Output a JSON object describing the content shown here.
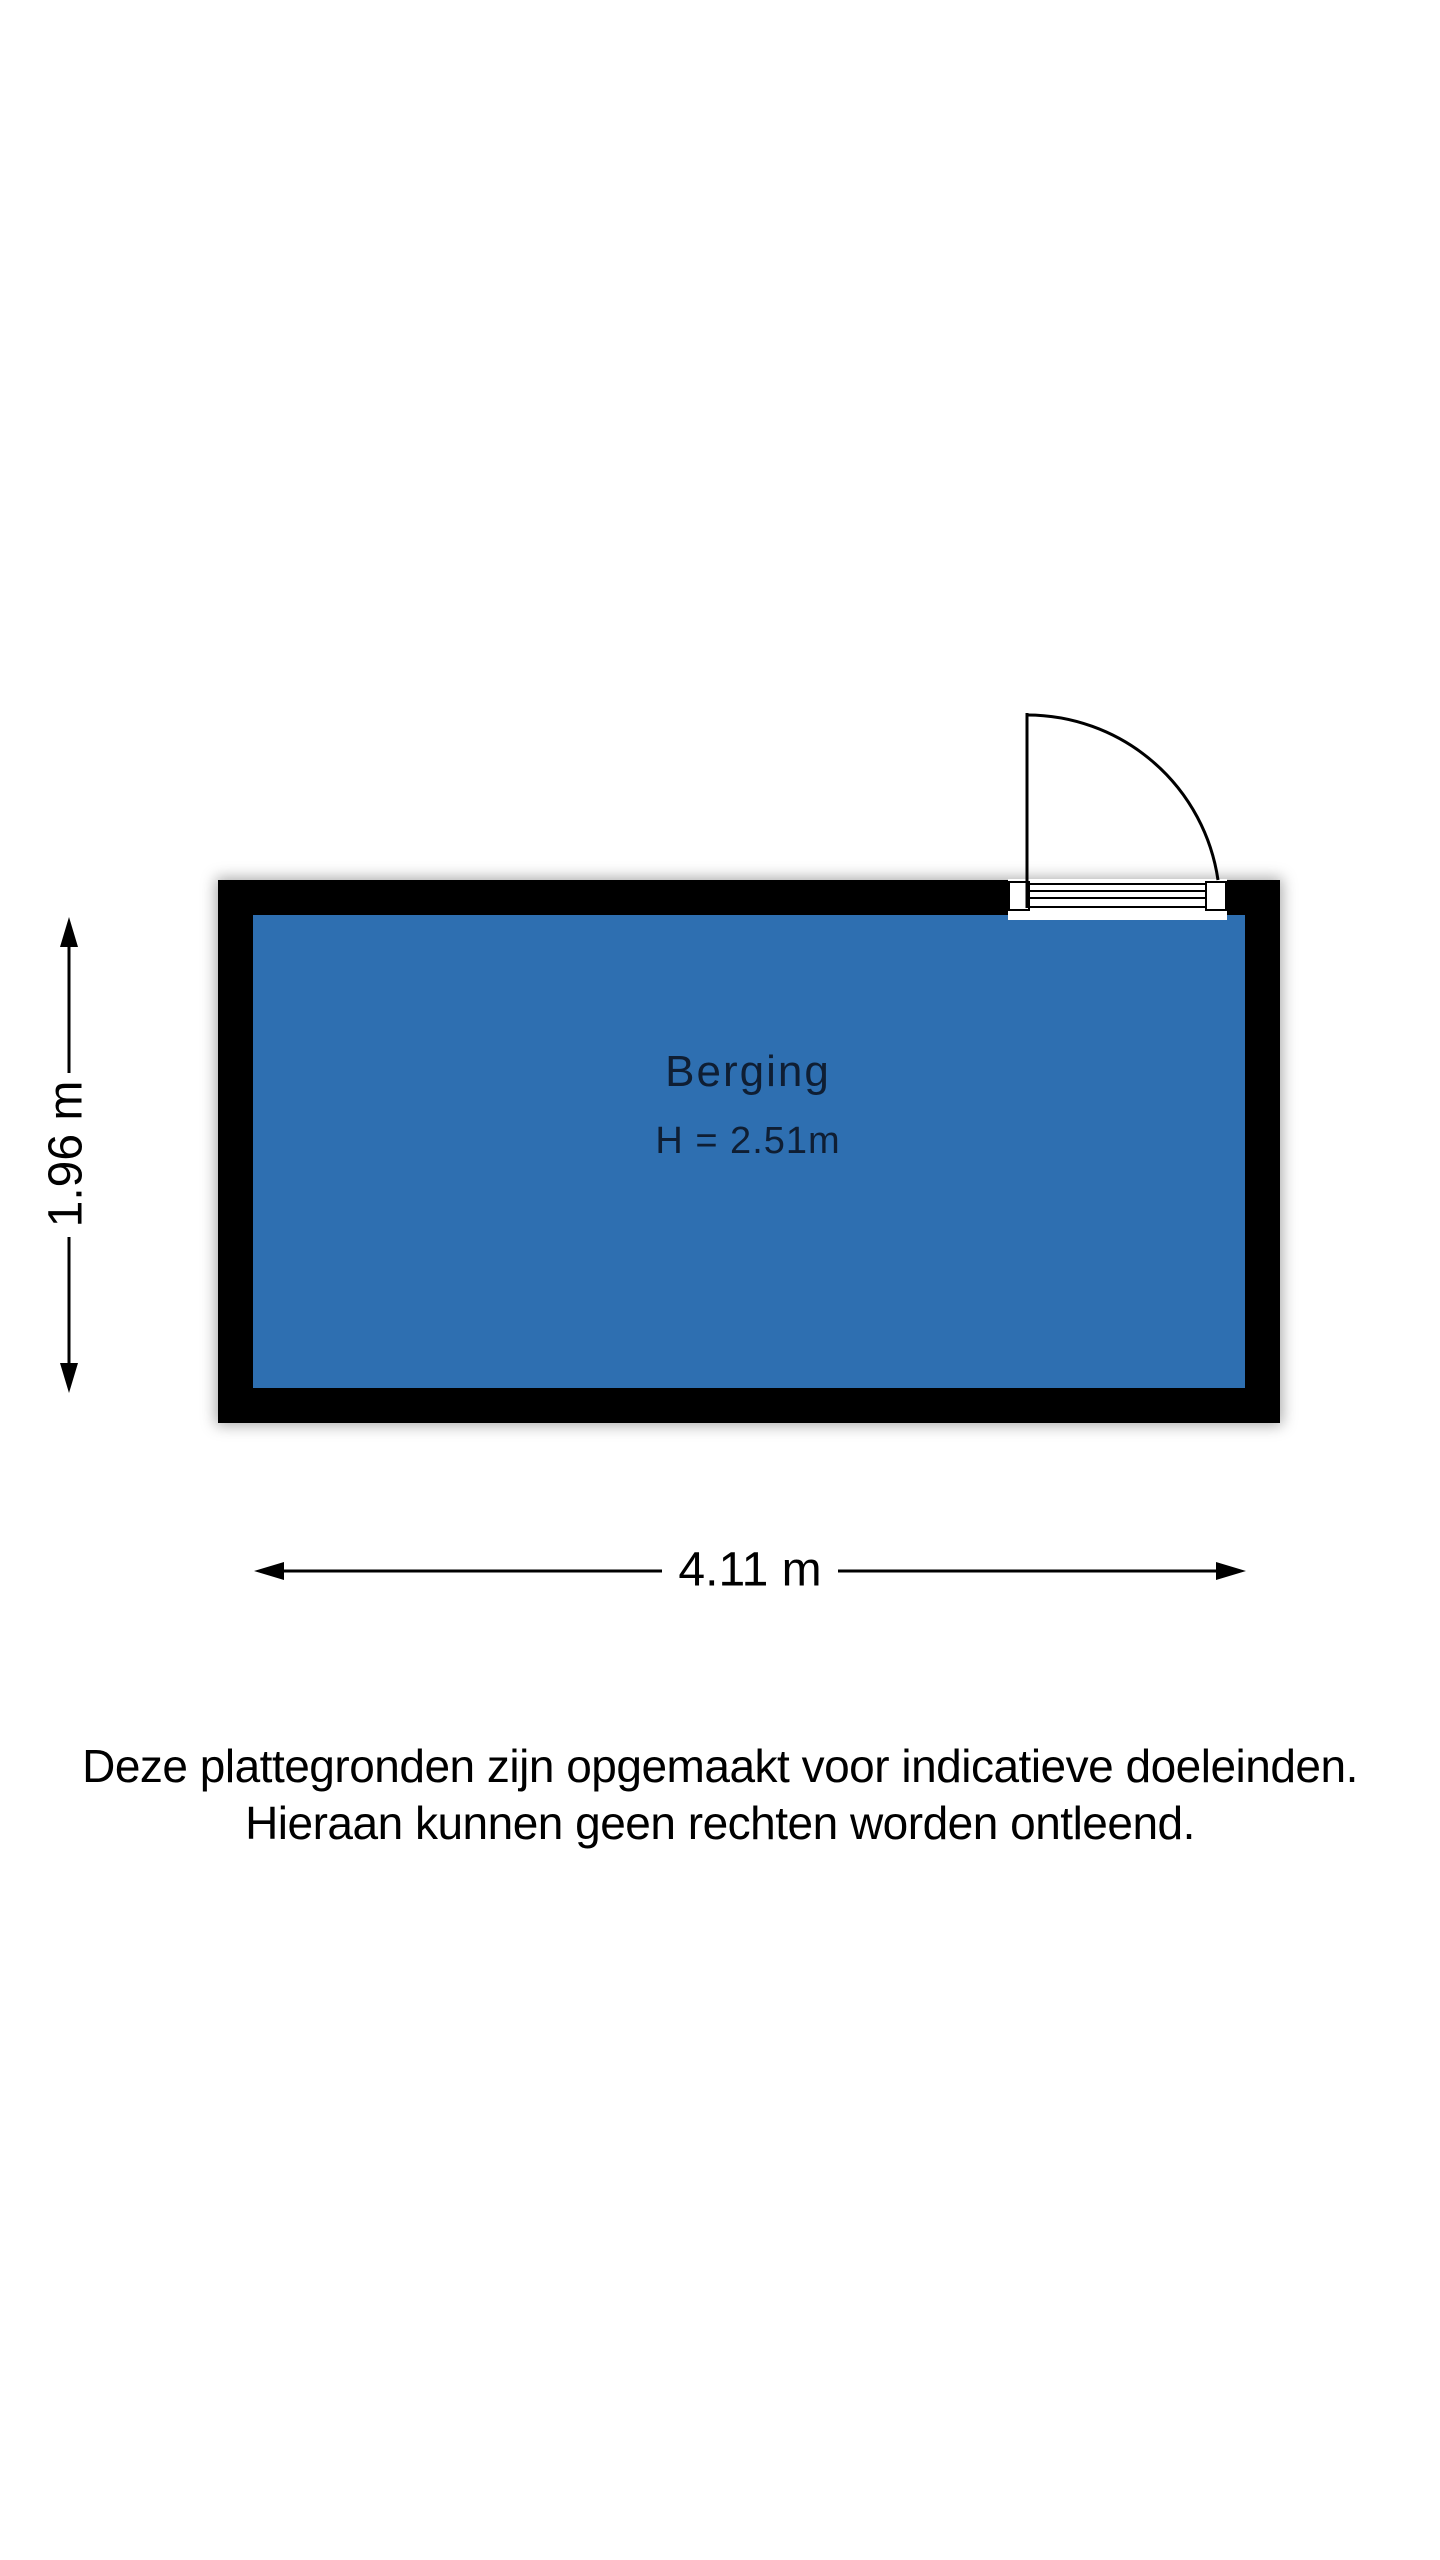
{
  "floorplan": {
    "room": {
      "name": "Berging",
      "ceiling_height": "H = 2.51m",
      "fill_color": "#2e6fb1",
      "wall_color": "#000000",
      "label_color": "#0f1e33"
    },
    "dimensions": {
      "width": "4.11 m",
      "depth": "1.96 m"
    },
    "door": {
      "type": "single-swing-door",
      "position": "top-right"
    }
  },
  "disclaimer": {
    "line1": "Deze plattegronden zijn opgemaakt voor indicatieve doeleinden.",
    "line2": "Hieraan kunnen geen rechten worden ontleend."
  }
}
